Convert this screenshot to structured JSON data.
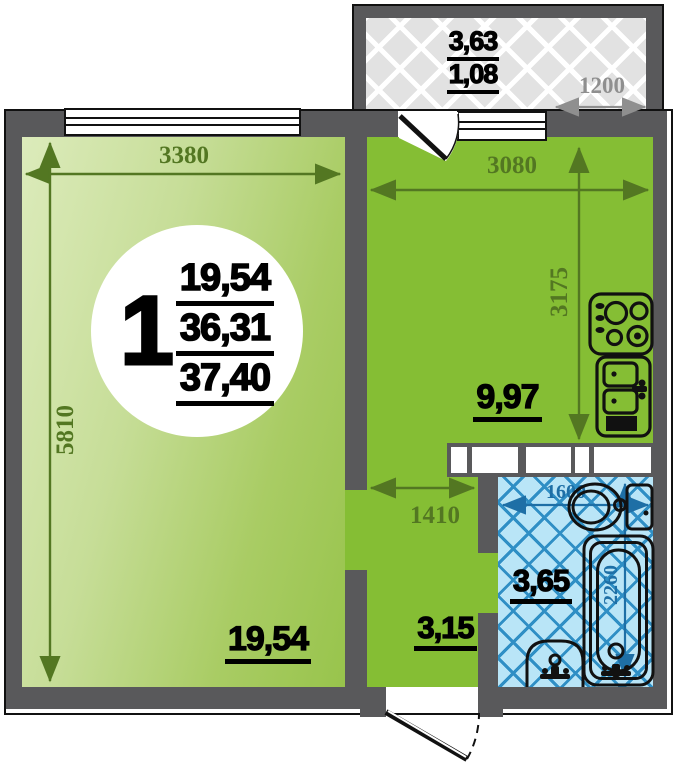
{
  "plan": {
    "unit": {
      "number": "1",
      "area_living": "19,54",
      "area_total": "36,31",
      "area_overall": "37,40"
    },
    "living": {
      "label": "19,54",
      "dim_width": "3380",
      "dim_height": "5810"
    },
    "kitchen": {
      "label": "9,97",
      "dim_width": "3080",
      "dim_height": "3175"
    },
    "hall": {
      "label": "3,15",
      "dim_width": "1410"
    },
    "bathroom": {
      "label": "3,65",
      "dim_width": "1600",
      "dim_height": "2260"
    },
    "balcony": {
      "label_top": "3,63",
      "label_bottom": "1,08",
      "dim_width": "1200"
    },
    "colors": {
      "wall": "#59595b",
      "kitchenGreen": "#85be34",
      "bathBlue": "#b9e5f7",
      "bathLine": "#2f8fc5",
      "dimGreen": "#537722",
      "dimBlue": "#1e6fa6",
      "dimGray": "#8f8f8f"
    }
  }
}
